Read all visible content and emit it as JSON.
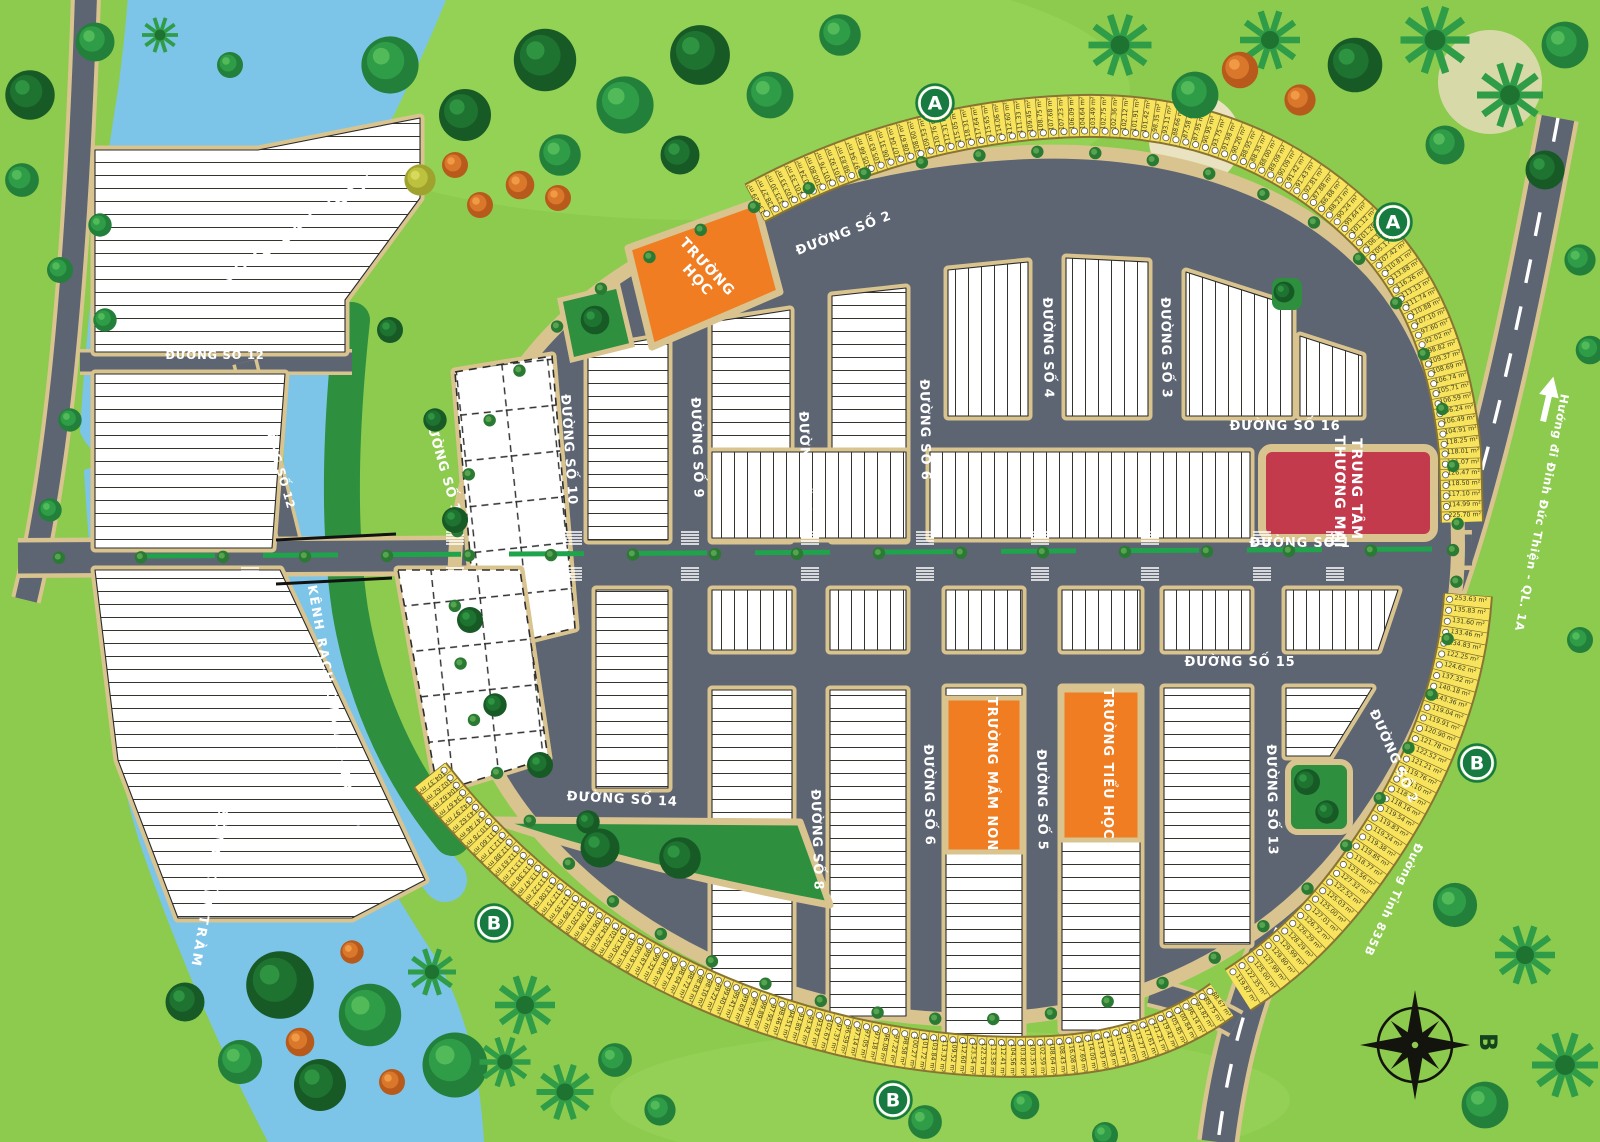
{
  "map": {
    "roads": {
      "d1": "ĐƯỜNG SỐ 1",
      "d2": "ĐƯỜNG SỐ 2",
      "d3": "ĐƯỜNG SỐ 3",
      "d4": "ĐƯỜNG SỐ 4",
      "d5": "ĐƯỜNG SỐ 5",
      "d6": "ĐƯỜNG SỐ 6",
      "d7": "ĐƯỜNG SỐ 7",
      "d8": "ĐƯỜNG SỐ 8",
      "d9": "ĐƯỜNG SỐ 9",
      "d10": "ĐƯỜNG SỐ 10",
      "d11": "ĐƯỜNG SỐ 11",
      "d12": "ĐƯỜNG SỐ 12",
      "d13": "ĐƯỜNG SỐ 13",
      "d14": "ĐƯỜNG SỐ 14",
      "d15": "ĐƯỜNG SỐ 15",
      "d16": "ĐƯỜNG SỐ 16",
      "provincial": "Đường Tỉnh 835B",
      "highway": "Hướng đi Đinh Đức Thiện - QL. 1A"
    },
    "waterways": {
      "river": "SÔNG CẦU TRÀM",
      "canal": "KÊNH RẠCH CHANH - TRỊ YÊN"
    },
    "zones": {
      "school": [
        "TRƯỜNG",
        "HỌC"
      ],
      "commercial": [
        "TRUNG TÂM",
        "THƯƠNG MẠI"
      ],
      "kindergarten": "TRƯỜNG MẦM NON",
      "primary": "TRƯỜNG TIỂU HỌC"
    },
    "markers": {
      "a": "A",
      "b": "B"
    },
    "area_unit": "m²",
    "colors": {
      "grass": "#8CCB4E",
      "park": "#2E8F3F",
      "water": "#7CC5E9",
      "road": "#5D6472",
      "shoulder": "#D9C48F",
      "lot_strip": "#F8E45C",
      "block": "#FFFFFF",
      "school_zone": "#F07D22",
      "commercial_zone": "#C23A4C",
      "marker_green": "#167A41",
      "median_green": "#1FA34B"
    },
    "lot_strips": {
      "north_arc": [
        "134.29",
        "128.27",
        "123.30",
        "102.33",
        "101.33",
        "100.24",
        "100.80",
        "101.76",
        "101.92",
        "98.83",
        "97.94",
        "105.66",
        "105.63",
        "106.31",
        "107.04",
        "108.67",
        "108.60",
        "109.53",
        "110.76",
        "112.31",
        "115.05",
        "118.31",
        "117.64",
        "115.65",
        "114.06",
        "112.60",
        "111.33",
        "109.45",
        "108.75",
        "107.68",
        "107.23",
        "106.09",
        "104.64",
        "103.49",
        "102.75",
        "102.36",
        "102.12",
        "101.91",
        "101.42",
        "98.35",
        "93.11",
        "88.66",
        "87.58",
        "87.95",
        "90.95",
        "93.75",
        "91.98",
        "90.20",
        "88.95",
        "88.35",
        "88.00",
        "89.09",
        "90.09",
        "91.42",
        "91.43",
        "92.81",
        "87.88",
        "86.88",
        "88.23",
        "90.24",
        "99.64",
        "101.12",
        "101.28",
        "106.17",
        "105.17",
        "107.42",
        "110.81",
        "113.88",
        "116.26",
        "113.13",
        "111.74",
        "110.88",
        "107.10",
        "97.60",
        "92.02",
        "98.82",
        "109.37",
        "108.69",
        "106.74",
        "105.71",
        "106.59",
        "106.24",
        "106.49",
        "104.91",
        "118.25",
        "118.01",
        "111.07",
        "126.47",
        "118.50",
        "117.10",
        "114.99",
        "225.70"
      ],
      "southeast": [
        "253.63",
        "135.83",
        "131.60",
        "133.46",
        "134.83",
        "122.25",
        "124.62",
        "137.32",
        "140.18",
        "143.36",
        "119.04",
        "119.91",
        "120.90",
        "121.78",
        "122.52",
        "121.21",
        "119.76",
        "119.10",
        "118.60",
        "118.16",
        "119.54",
        "119.83",
        "119.24",
        "119.38",
        "119.85",
        "118.77",
        "123.56",
        "127.32",
        "122.52",
        "125.03",
        "125.00",
        "127.01",
        "126.72",
        "126.29",
        "128.29",
        "129.99",
        "129.80",
        "127.99",
        "125.00",
        "122.35",
        "119.87"
      ],
      "south": [
        "104.37",
        "102.62",
        "104.62",
        "134.67",
        "142.97",
        "143.62",
        "147.46",
        "110.78",
        "111.60",
        "112.17",
        "112.88",
        "112.63",
        "113.12",
        "113.38",
        "113.47",
        "113.22",
        "113.08",
        "112.75",
        "112.35",
        "111.89",
        "110.20",
        "107.98",
        "106.01",
        "104.26",
        "102.50",
        "101.50",
        "100.81",
        "100.19",
        "99.67",
        "99.32",
        "98.66",
        "98.57",
        "98.64",
        "98.72",
        "98.83",
        "98.10",
        "99.22",
        "99.40",
        "99.41",
        "99.69",
        "99.60",
        "99.89",
        "97.95",
        "98.46",
        "94.51",
        "93.80",
        "93.42",
        "93.67",
        "102.67",
        "97.37",
        "96.59",
        "97.14",
        "97.05",
        "97.18",
        "96.08",
        "97.22",
        "98.58",
        "100.27",
        "101.72",
        "103.84",
        "113.32",
        "109.52",
        "112.60",
        "123.54",
        "122.53",
        "113.58",
        "112.41",
        "104.56",
        "103.82",
        "103.35",
        "102.59",
        "108.64",
        "108.43",
        "116.08",
        "117.69",
        "114.00",
        "113.93",
        "117.38",
        "113.52",
        "109.20",
        "113.27",
        "117.61",
        "121.21",
        "119.42",
        "105.85",
        "100.84",
        "96.14",
        "93.82",
        "89.75",
        "88.67"
      ]
    }
  }
}
